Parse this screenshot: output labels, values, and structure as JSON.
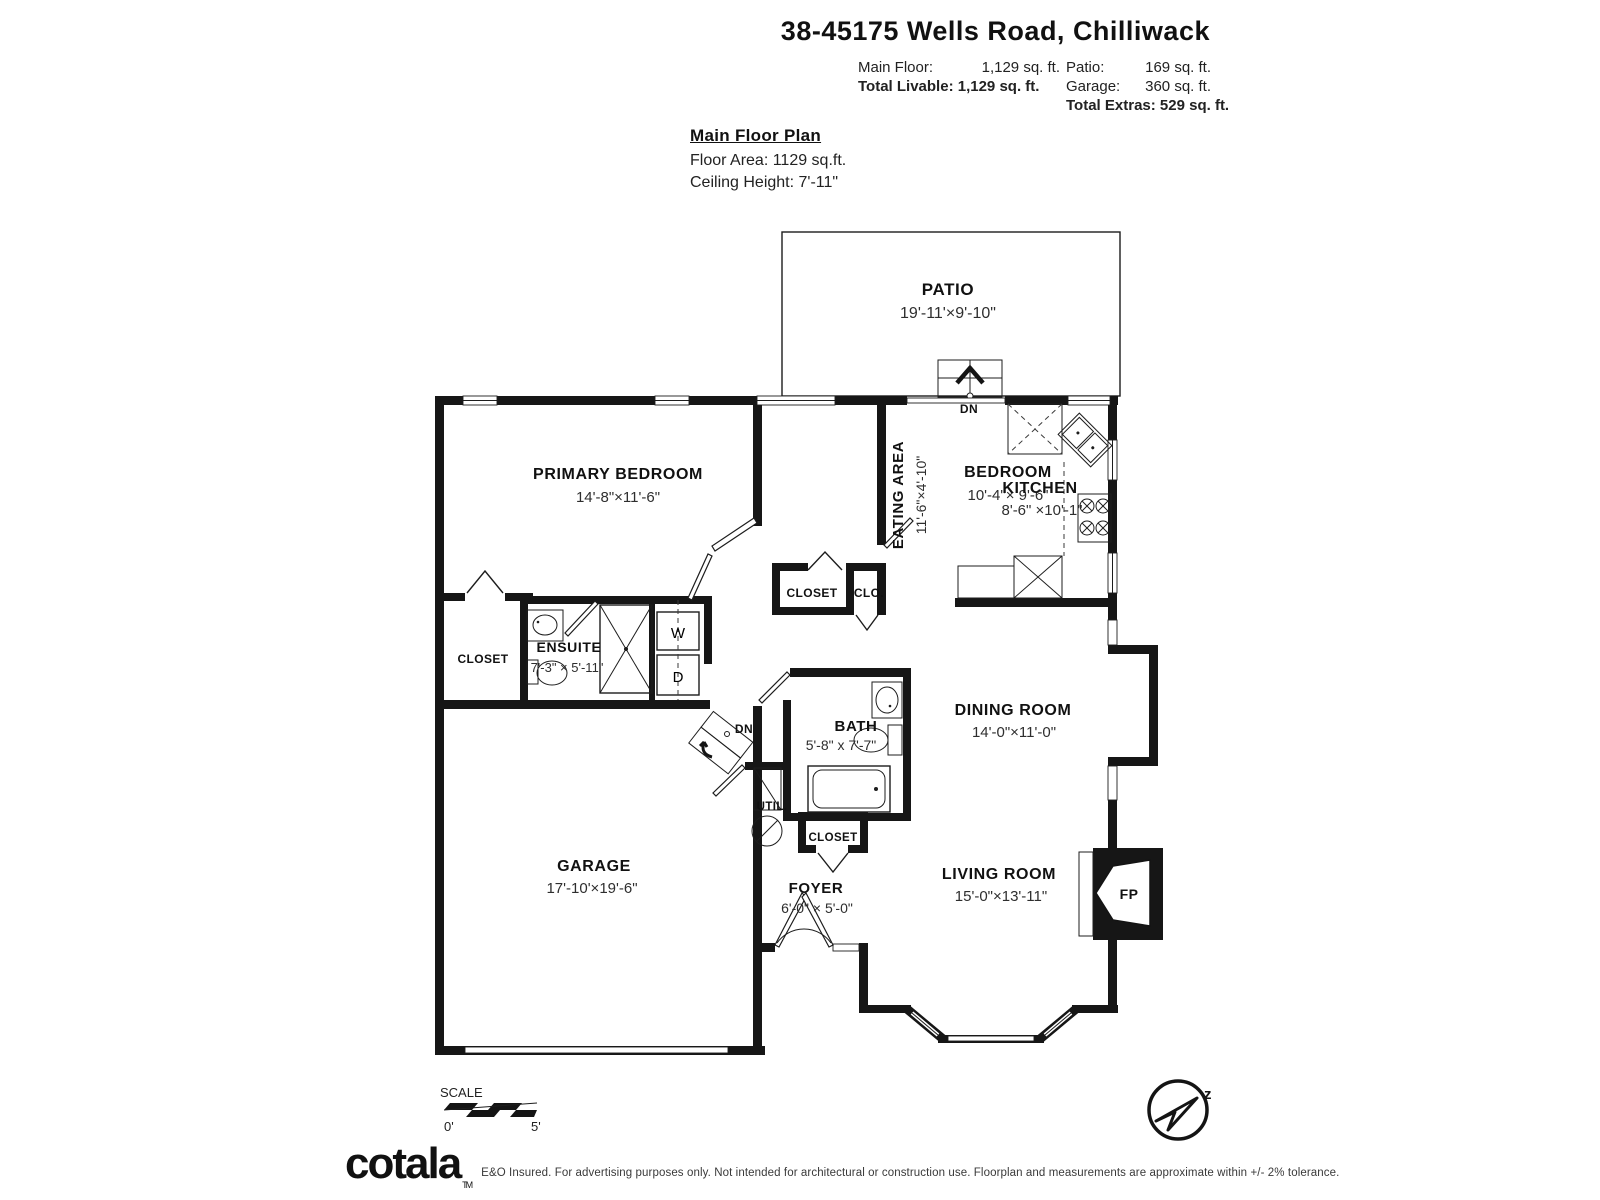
{
  "header": {
    "address": "38-45175 Wells Road, Chilliwack",
    "stats": {
      "main_floor_label": "Main Floor:",
      "main_floor_value": "1,129 sq. ft.",
      "total_livable": "Total Livable: 1,129 sq. ft.",
      "patio_label": "Patio:",
      "patio_value": "169 sq. ft.",
      "garage_label": "Garage:",
      "garage_value": "360 sq. ft.",
      "total_extras": "Total Extras: 529 sq. ft."
    }
  },
  "plan_info": {
    "title": "Main Floor Plan",
    "floor_area": "Floor Area: 1129 sq.ft.",
    "ceiling_height": "Ceiling Height: 7'-11\""
  },
  "rooms": {
    "patio": {
      "name": "PATIO",
      "dims": "19'-11'×9'-10\""
    },
    "primary_bedroom": {
      "name": "PRIMARY BEDROOM",
      "dims": "14'-8\"×11'-6\""
    },
    "bedroom": {
      "name": "BEDROOM",
      "dims": "10'-4\"× 9'-6\""
    },
    "eating_area": {
      "name": "EATING AREA",
      "dims": "11'-6\"×4'-10\""
    },
    "kitchen": {
      "name": "KITCHEN",
      "dims": "8'-6\" ×10'-1\""
    },
    "ensuite": {
      "name": "ENSUITE",
      "dims": "7'-3\" × 5'-11\""
    },
    "bath": {
      "name": "BATH",
      "dims": "5'-8\" x 7'-7\""
    },
    "dining_room": {
      "name": "DINING ROOM",
      "dims": "14'-0\"×11'-0\""
    },
    "garage": {
      "name": "GARAGE",
      "dims": "17'-10'×19'-6\""
    },
    "foyer": {
      "name": "FOYER",
      "dims": "6'-0\" × 5'-0\""
    },
    "living_room": {
      "name": "LIVING ROOM",
      "dims": "15'-0\"×13'-11\""
    },
    "closet_primary": "CLOSET",
    "closet_bedroom": "CLOSET",
    "closet_small": "CLO.",
    "closet_foyer": "CLOSET",
    "util": "UTIL.",
    "washer": "W",
    "dryer": "D",
    "fireplace": "FP",
    "dn_patio": "DN",
    "dn_stairs": "DN"
  },
  "scale": {
    "label": "SCALE",
    "start": "0'",
    "end": "5'"
  },
  "compass": {
    "north_letter": "z"
  },
  "footer": {
    "logo": "cotala",
    "logo_tm": "TM",
    "disclaimer": "E&O Insured. For advertising purposes only. Not intended for architectural or construction use. Floorplan and measurements are approximate within +/- 2% tolerance."
  }
}
